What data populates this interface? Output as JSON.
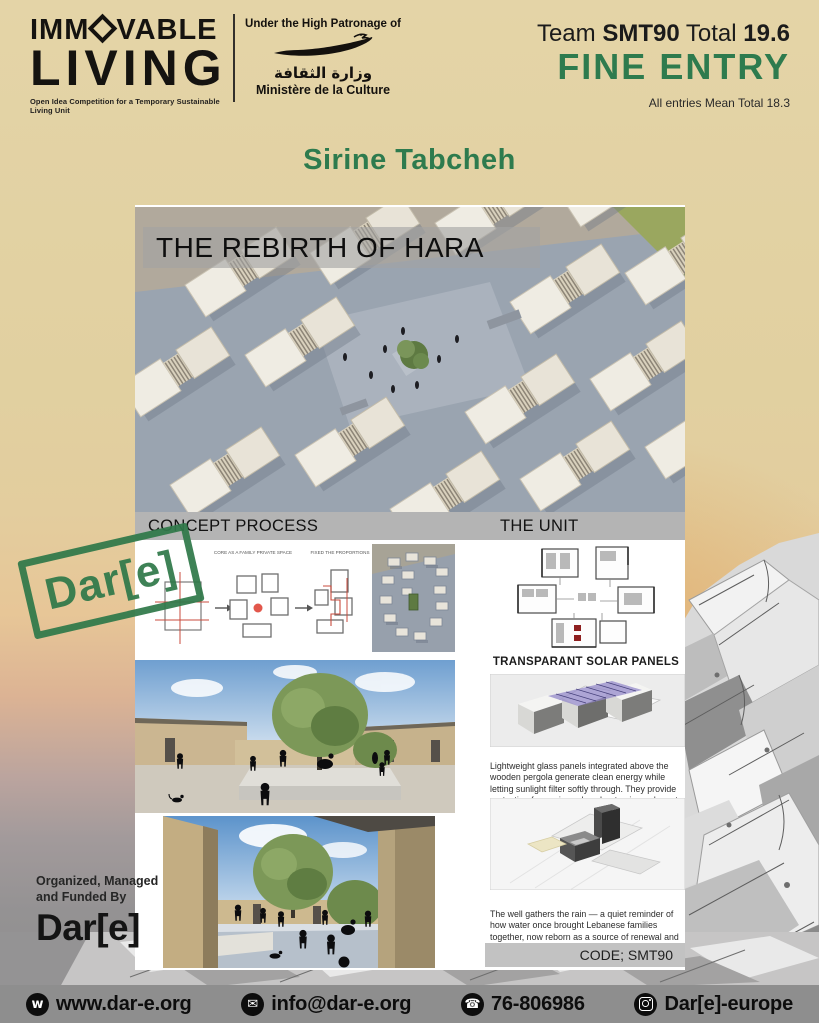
{
  "header": {
    "logo": {
      "word1_part1": "IMM",
      "word1_part2": "VABLE",
      "word2": "LIVING",
      "tagline": "Open Idea Competition for a Temporary Sustainable Living Unit"
    },
    "patronage": {
      "line": "Under the High Patronage of",
      "arabic": "وزارة الثقافة",
      "french": "Ministère de la Culture"
    },
    "score": {
      "team_label": "Team ",
      "team_code": "SMT90",
      "total_label": " Total ",
      "total_value": "19.6",
      "entry_status": "FINE ENTRY",
      "mean_note": "All entries Mean Total 18.3"
    }
  },
  "entrant_name": "Sirine Tabcheh",
  "poster": {
    "hero_title": "THE REBIRTH OF HARA",
    "left_section_title": "CONCEPT PROCESS",
    "right_section_title": "THE UNIT",
    "concept_labels": {
      "step2": "CORE AS A FAMILY PRIVATE SPACE",
      "step3": "FIXED THE PROPORTIONS"
    },
    "unit": {
      "solar_heading": "TRANSPARANT SOLAR PANELS",
      "solar_text": "Lightweight glass panels integrated above the wooden pergola generate clean energy while letting sunlight filter softly through. They provide protection from rain, reduce heat gain, and create dappled light",
      "well_text": "The well gathers the rain — a quiet reminder of how water once brought Lebanese families together, now reborn as a source of renewal and life.",
      "code_label": "CODE; SMT90"
    }
  },
  "stamp": {
    "text": "Dar[e]"
  },
  "organizer": {
    "line1": "Organized, Managed",
    "line2": "and Funded By",
    "logo": "Dar[e]"
  },
  "footer": {
    "website": {
      "glyph": "w",
      "label": "www.dar-e.org"
    },
    "email": {
      "glyph": "✉",
      "label": "info@dar-e.org"
    },
    "phone": {
      "glyph": "☎",
      "label": "76-806986"
    },
    "social": {
      "label": "Dar[e]-europe"
    }
  },
  "colors": {
    "accent_green": "#2e7b4e",
    "background_tan": "#e2d2a3",
    "footer_gray": "#8e8e8e"
  }
}
